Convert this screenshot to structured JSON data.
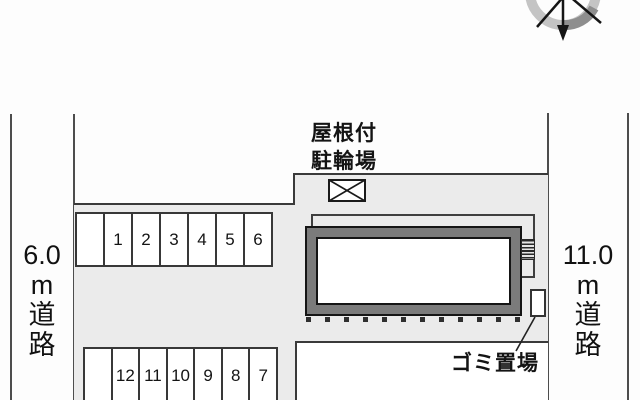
{
  "title": "site-plan",
  "roads": {
    "left": {
      "lines": [
        "6.0",
        "m",
        "道",
        "路"
      ]
    },
    "right": {
      "lines": [
        "11.0",
        "m",
        "道",
        "路"
      ]
    }
  },
  "labels": {
    "bike_shed_line1": "屋根付",
    "bike_shed_line2": "駐輪場",
    "garbage": "ゴミ置場"
  },
  "parking": {
    "top_row": [
      "",
      "1",
      "2",
      "3",
      "4",
      "5",
      "6"
    ],
    "bottom_row": [
      "",
      "12",
      "11",
      "10",
      "9",
      "8",
      "7"
    ]
  },
  "icons": {
    "compass": "compass-rose-north-arrow",
    "bike_shed_symbol": "crossed-rectangle",
    "stairs_symbol": "hatched-steps"
  },
  "colors": {
    "site_fill": "#ebebeb",
    "building_wall": "#7b7b7b",
    "outline": "#3a3a3a",
    "background": "#ffffff"
  }
}
